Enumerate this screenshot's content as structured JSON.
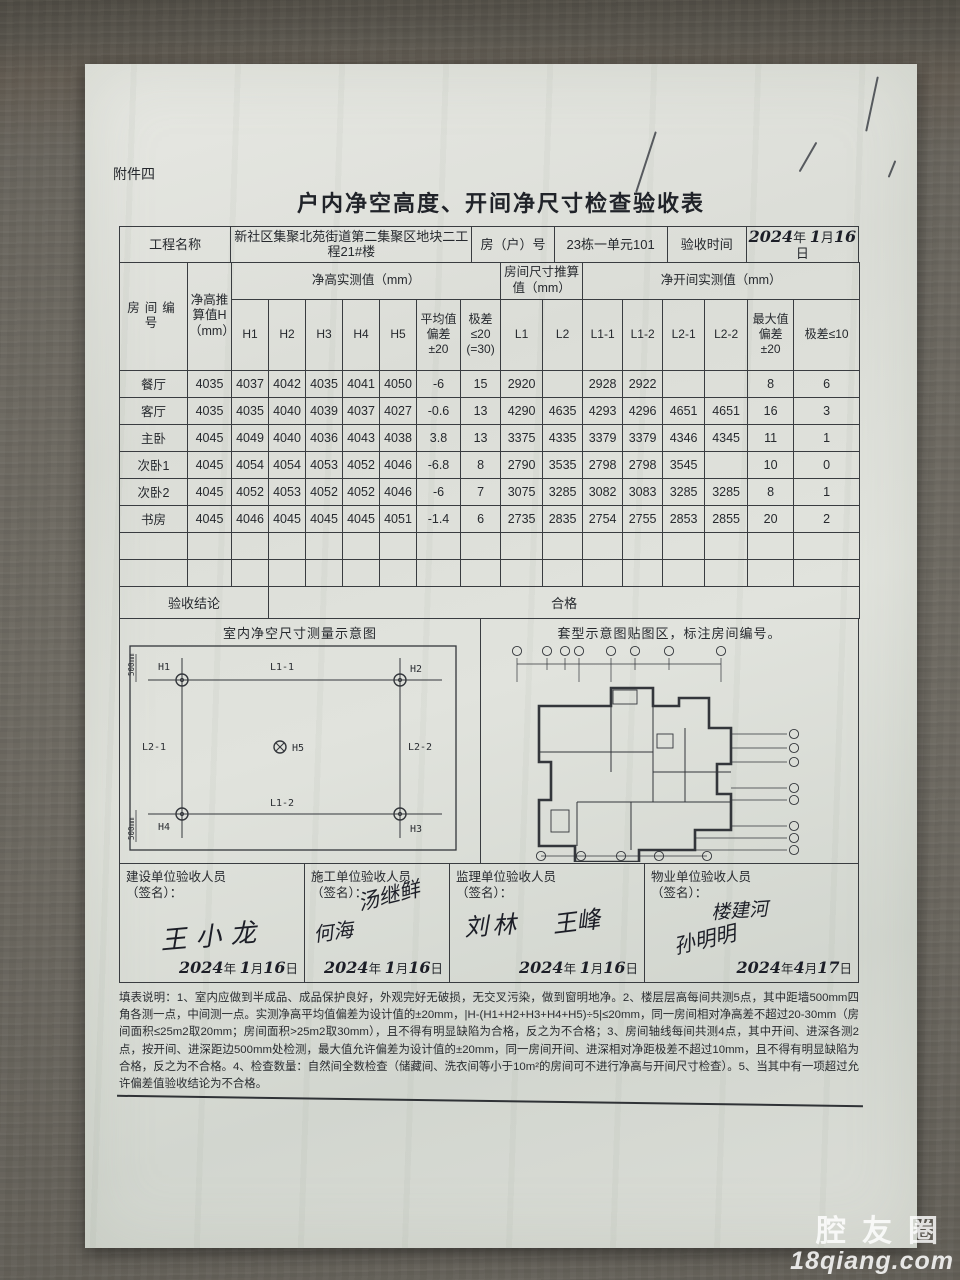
{
  "watermark": {
    "brand": "腔友圈",
    "domain": "18qiang.com"
  },
  "doc": {
    "attachment": "附件四",
    "title": "户内净空高度、开间净尺寸检查验收表",
    "date_units": {
      "y": "年",
      "m": "月",
      "d": "日"
    },
    "info": {
      "project_label": "工程名称",
      "project_value": "新社区集聚北苑街道第二集聚区地块二工程21#楼",
      "unit_label": "房（户）号",
      "unit_value": "23栋一单元101",
      "date_label": "验收时间",
      "date_year": "2024",
      "date_month": "1",
      "date_day": "16"
    },
    "table": {
      "headers": {
        "room": "房间编号",
        "h_design": "净高推算值H（mm）",
        "h_group": "净高实测值（mm）",
        "h1": "H1",
        "h2": "H2",
        "h3": "H3",
        "h4": "H4",
        "h5": "H5",
        "avg_dev": "平均值偏差±20",
        "range20": "极差≤20 (=30)",
        "size_group": "房间尺寸推算值（mm）",
        "l1": "L1",
        "l2": "L2",
        "bay_group": "净开间实测值（mm）",
        "l11": "L1-1",
        "l12": "L1-2",
        "l21": "L2-1",
        "l22": "L2-2",
        "max_dev": "最大值偏差±20",
        "range10": "极差≤10"
      },
      "rows": [
        {
          "cells": [
            "餐厅",
            "4035",
            "4037",
            "4042",
            "4035",
            "4041",
            "4050",
            "-6",
            "15",
            "2920",
            "",
            "2928",
            "2922",
            "",
            "",
            "8",
            "6"
          ]
        },
        {
          "cells": [
            "客厅",
            "4035",
            "4035",
            "4040",
            "4039",
            "4037",
            "4027",
            "-0.6",
            "13",
            "4290",
            "4635",
            "4293",
            "4296",
            "4651",
            "4651",
            "16",
            "3"
          ]
        },
        {
          "cells": [
            "主卧",
            "4045",
            "4049",
            "4040",
            "4036",
            "4043",
            "4038",
            "3.8",
            "13",
            "3375",
            "4335",
            "3379",
            "3379",
            "4346",
            "4345",
            "11",
            "1"
          ]
        },
        {
          "cells": [
            "次卧1",
            "4045",
            "4054",
            "4054",
            "4053",
            "4052",
            "4046",
            "-6.8",
            "8",
            "2790",
            "3535",
            "2798",
            "2798",
            "3545",
            "",
            "10",
            "0"
          ]
        },
        {
          "cells": [
            "次卧2",
            "4045",
            "4052",
            "4053",
            "4052",
            "4052",
            "4046",
            "-6",
            "7",
            "3075",
            "3285",
            "3082",
            "3083",
            "3285",
            "3285",
            "8",
            "1"
          ]
        },
        {
          "cells": [
            "书房",
            "4045",
            "4046",
            "4045",
            "4045",
            "4045",
            "4051",
            "-1.4",
            "6",
            "2735",
            "2835",
            "2754",
            "2755",
            "2853",
            "2855",
            "20",
            "2"
          ]
        },
        {
          "cells": [
            "",
            "",
            "",
            "",
            "",
            "",
            "",
            "",
            "",
            "",
            "",
            "",
            "",
            "",
            "",
            "",
            ""
          ]
        },
        {
          "cells": [
            "",
            "",
            "",
            "",
            "",
            "",
            "",
            "",
            "",
            "",
            "",
            "",
            "",
            "",
            "",
            "",
            ""
          ]
        }
      ],
      "conclusion_label": "验收结论",
      "conclusion_value": "合格"
    },
    "diagrams": {
      "left_caption": "室内净空尺寸测量示意图",
      "right_caption": "套型示意图贴图区，标注房间编号。",
      "labels": {
        "h1": "H1",
        "h2": "H2",
        "h3": "H3",
        "h4": "H4",
        "h5": "H5",
        "l11": "L1-1",
        "l12": "L1-2",
        "l21": "L2-1",
        "l22": "L2-2",
        "edge_top": "500mm",
        "edge_bottom": "500mm"
      }
    },
    "signatures": [
      {
        "role": "建设单位验收人员",
        "sub": "（签名）：",
        "names": [
          "王小龙"
        ],
        "date_y": "2024",
        "date_m": "1",
        "date_d": "16"
      },
      {
        "role": "施工单位验收人员",
        "sub": "（签名）：",
        "names": [
          "汤继鲜",
          "何海"
        ],
        "date_y": "2024",
        "date_m": "1",
        "date_d": "16"
      },
      {
        "role": "监理单位验收人员",
        "sub": "（签名）：",
        "names": [
          "刘林",
          "王峰"
        ],
        "date_y": "2024",
        "date_m": "1",
        "date_d": "16"
      },
      {
        "role": "物业单位验收人员",
        "sub": "（签名）：",
        "names": [
          "楼建河",
          "孙明明"
        ],
        "date_y": "2024",
        "date_m": "4",
        "date_d": "17"
      }
    ],
    "notes": "填表说明：1、室内应做到半成品、成品保护良好，外观完好无破损，无交叉污染，做到窗明地净。2、楼层层高每间共测5点，其中距墙500mm四角各测一点，中间测一点。实测净高平均值偏差为设计值的±20mm，|H-(H1+H2+H3+H4+H5)÷5|≤20mm，同一房间相对净高差不超过20-30mm（房间面积≤25m2取20mm；房间面积>25m2取30mm），且不得有明显缺陷为合格，反之为不合格；3、房间轴线每间共测4点，其中开间、进深各测2点，按开间、进深距边500mm处检测，最大值允许偏差为设计值的±20mm，同一房间开间、进深相对净距极差不超过10mm，且不得有明显缺陷为合格，反之为不合格。4、检查数量：自然间全数检查（储藏间、洗衣间等小于10m²的房间可不进行净高与开间尺寸检查）。5、当其中有一项超过允许偏差值验收结论为不合格。"
  }
}
